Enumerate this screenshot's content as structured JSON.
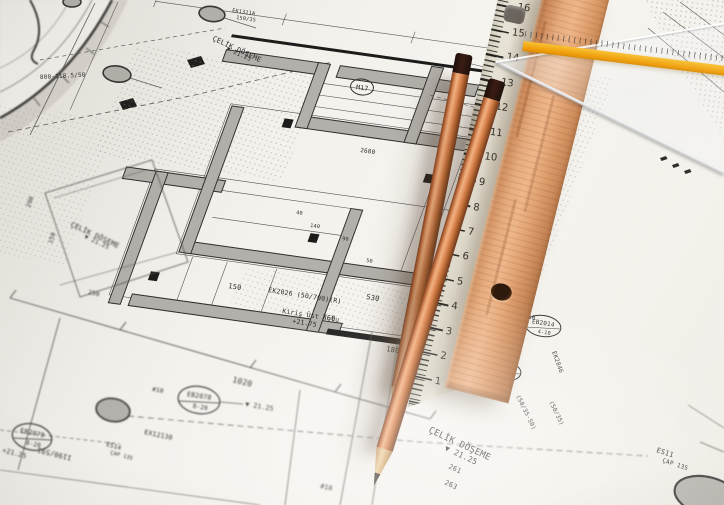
{
  "blueprint": {
    "notes": {
      "celik_doseme": "ÇELİK DÖŞEME",
      "elev_down_2125": "▼ 21.25",
      "elev_plus_2125": "+21.25",
      "kiris_ust_kotu": "Kiriş Üst Kotu",
      "elev_plus_2175": "+21.75",
      "beam_ek2026": "EK2026 (50/700)(R)",
      "arc_note": "800-118.5/50",
      "ex12130": "EX12130",
      "ratio_1190": "1190/591",
      "es14": "ES14",
      "es11": "ES11",
      "cap135": "ÇAP 135",
      "ek1311a": "EK1311A",
      "b15035": "150/35",
      "ek2023": "EK2023",
      "ek2021": "EK2021",
      "ek2846": "EK2846",
      "b5035_50": "(50/35-50)",
      "b5035": "(50/35)",
      "m17": "M17",
      "rebar10a": "#10",
      "rebar10b": "#10"
    },
    "circle_tags": {
      "c1": {
        "name": "EB2078",
        "size": "8-20"
      },
      "c2": {
        "name": "EB2079",
        "size": "8-20"
      },
      "c3": {
        "name": "EB2014",
        "size": "4-10"
      },
      "c4": {
        "name": "EB2028",
        "size": "4-10"
      }
    },
    "dims": {
      "d1020": "1020",
      "d530": "530",
      "d360": "360",
      "d2680": "2680",
      "d263": "263",
      "d261": "261",
      "d250": "250",
      "d290": "290",
      "d180": "180",
      "d150": "150",
      "d140": "140",
      "d90": "90",
      "d50": "50",
      "d40": "40",
      "d20": "20"
    }
  },
  "rulers": {
    "white": {
      "numbers": [
        "1",
        "2",
        "3",
        "4",
        "5",
        "6",
        "7",
        "8",
        "9",
        "10",
        "11",
        "12",
        "13",
        "14",
        "15",
        "16"
      ]
    }
  },
  "colors": {
    "paper": "#f3f1ec",
    "plan_wall": "#b3b0ab",
    "ink": "#2e2e2e",
    "pencil_wood": "#d98a58",
    "pencil_cap": "#241310",
    "ruler_cream": "#ece8da",
    "ruler_wood": "#dfa273",
    "square_stripe": "#f0a516"
  }
}
